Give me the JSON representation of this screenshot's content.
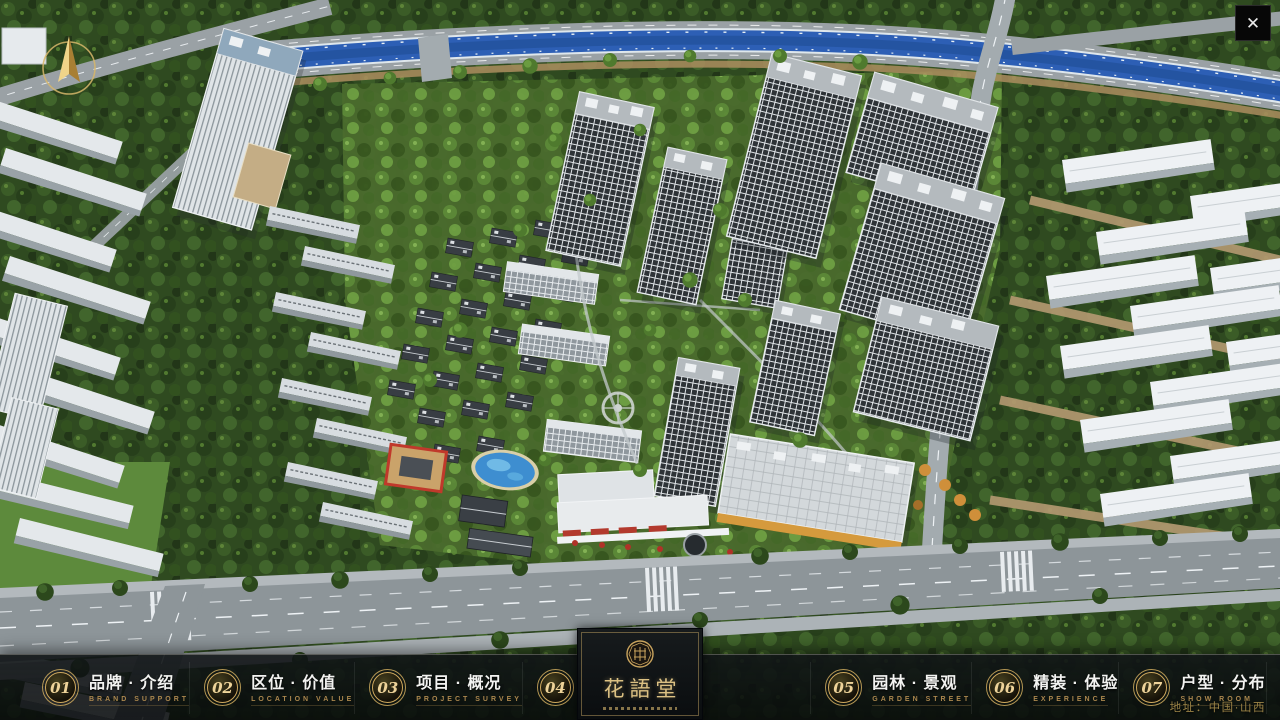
{
  "window": {
    "close_icon_glyph": "✕"
  },
  "navbar": {
    "items": [
      {
        "num": "01",
        "label": "品牌 · 介绍",
        "sub": "BRAND SUPPORT"
      },
      {
        "num": "02",
        "label": "区位 · 价值",
        "sub": "LOCATION VALUE"
      },
      {
        "num": "03",
        "label": "项目 · 概况",
        "sub": "PROJECT SURVEY"
      },
      {
        "num": "04",
        "label": "建筑 · 鉴赏",
        "sub": "APPRECIATION"
      },
      {
        "num": "05",
        "label": "园林 · 景观",
        "sub": "GARDEN STREET"
      },
      {
        "num": "06",
        "label": "精装 · 体验",
        "sub": "EXPERIENCE"
      },
      {
        "num": "07",
        "label": "户型 · 分布",
        "sub": "SHOW ROOM"
      },
      {
        "num": "08",
        "label": "一房 · 一景",
        "sub": "COMMUNITY"
      }
    ]
  },
  "logo": {
    "title": "花語堂"
  },
  "footer": {
    "address": "地址：中国·山西"
  },
  "colors": {
    "accent_gold": "#cfa95e",
    "bar_background": "#0a0d0f",
    "river_blue": "#2d5fb5",
    "tree_green": "#3b5c27",
    "road_gray": "#9aa1a5"
  }
}
